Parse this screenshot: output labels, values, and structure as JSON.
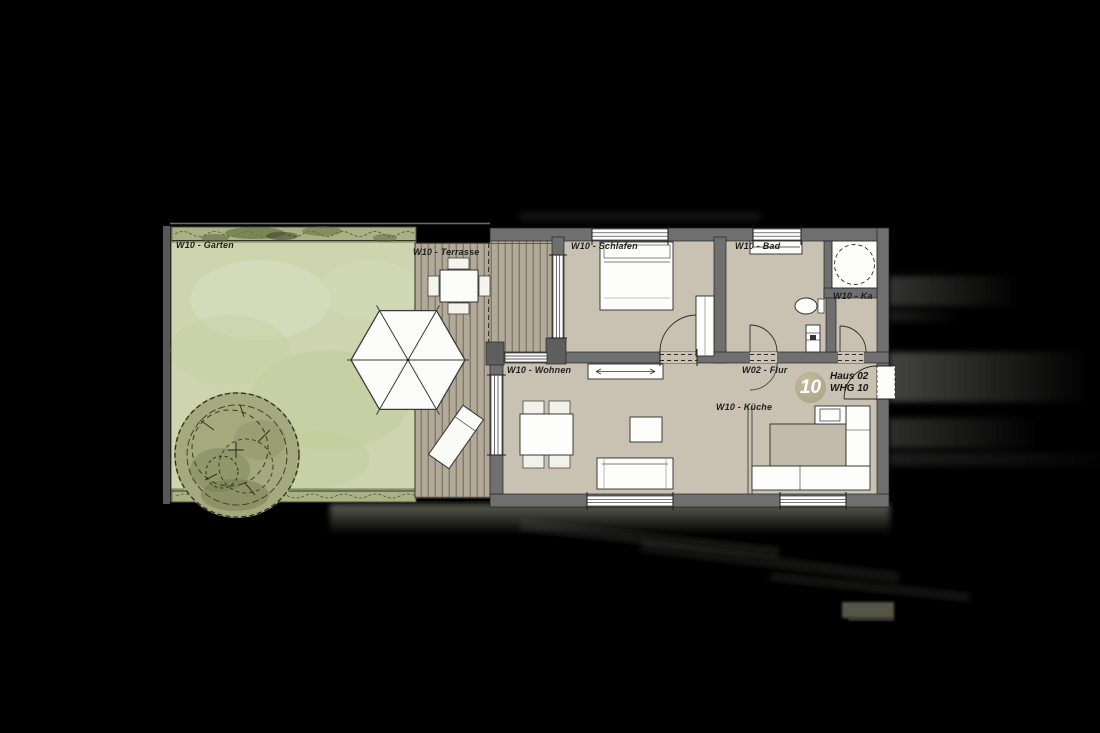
{
  "meta": {
    "drawing_type": "apartment floor plan"
  },
  "unit": {
    "badge_number": "10",
    "house": "Haus 02",
    "apartment": "WHG 10"
  },
  "rooms": [
    {
      "id": "garten",
      "label": "W10 - Garten"
    },
    {
      "id": "terrasse",
      "label": "W10 - Terrasse"
    },
    {
      "id": "schlafen",
      "label": "W10 - Schlafen"
    },
    {
      "id": "bad",
      "label": "W10 - Bad"
    },
    {
      "id": "kammer",
      "label": "W10 - Ka"
    },
    {
      "id": "wohnen",
      "label": "W10 - Wohnen"
    },
    {
      "id": "flur",
      "label": "W02 - Flur"
    },
    {
      "id": "kueche",
      "label": "W10 - Küche"
    }
  ],
  "colors": {
    "background": "#000000",
    "lawn": "#cdd4ae",
    "hedge": "#aab285",
    "deck": "#b2a999",
    "floor": "#c9c2b2",
    "wall": "#6f6f6f",
    "fixture": "#fdfdfb",
    "badge": "#b6ae90",
    "ink": "#2b2b2b"
  }
}
